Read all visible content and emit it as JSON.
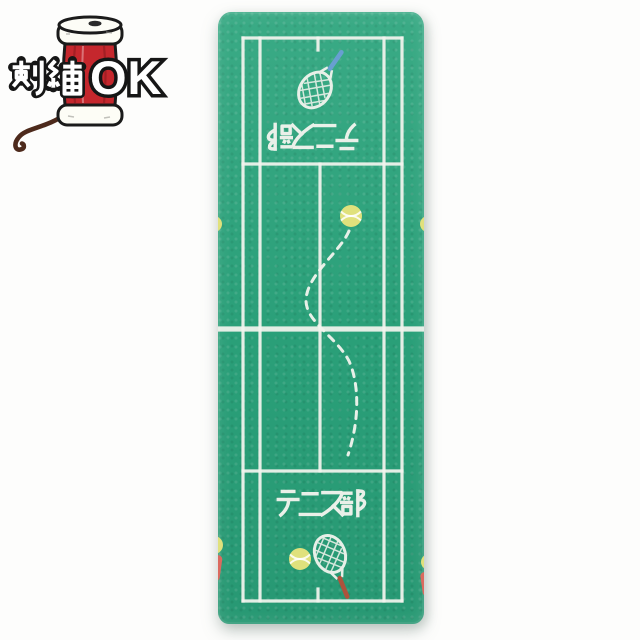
{
  "badge": {
    "label": "刺繍OK",
    "kanji_text": "刺繍",
    "ok_text": "OK",
    "icon": "thread-spool-icon"
  },
  "towel": {
    "club_text": "テニス部",
    "club_text_top": "テニス部",
    "court_motif": "tennis-court",
    "icons": {
      "top": "tennis-racket-icon",
      "ball_top": "tennis-ball-icon",
      "trajectory": "bouncing-ball-dashed-path",
      "ball_bottom": "tennis-ball-icon",
      "bottom": "tennis-racket-icon"
    }
  },
  "colors": {
    "fabric": "#2ba47c",
    "court_line": "#f2f4ee",
    "ball": "#e0e17c",
    "racket_handle_top": "#6b9fd6",
    "racket_handle_bottom": "#b5503a",
    "badge_spool": "#c5272d",
    "badge_thread": "#4d2a1c",
    "edge_red": "#db6a5f",
    "photo_bg": "#fdfdfc"
  }
}
